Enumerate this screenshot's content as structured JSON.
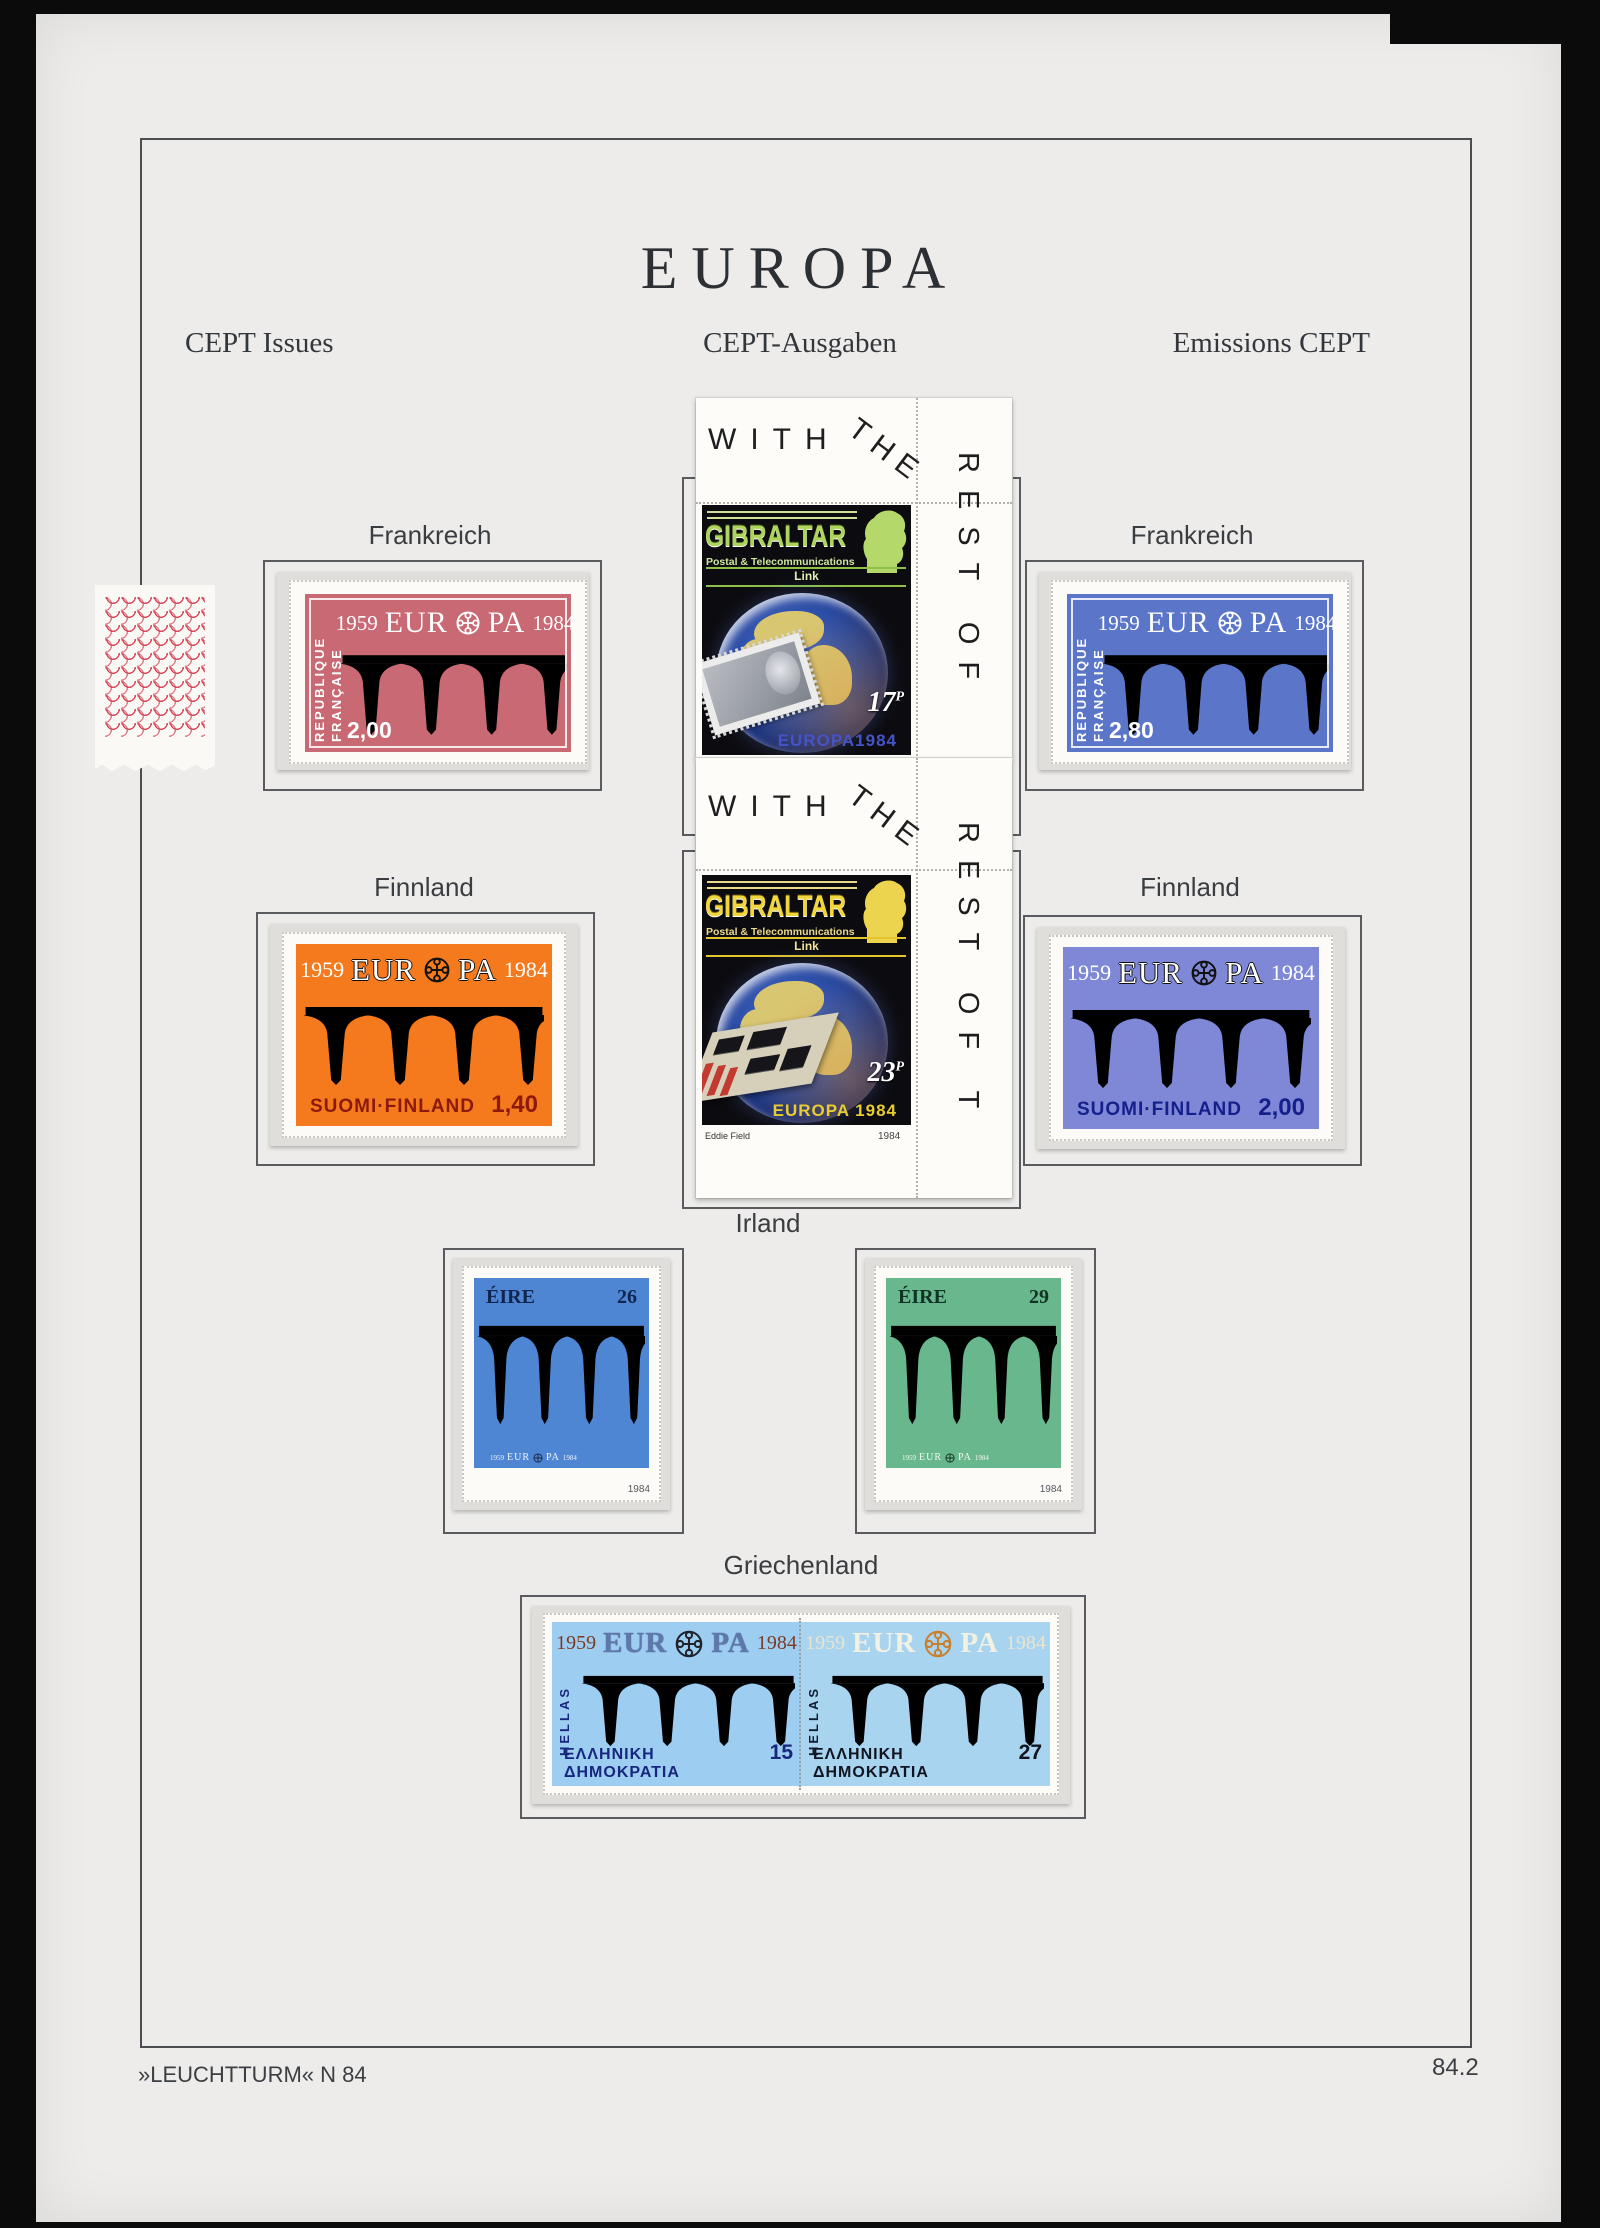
{
  "page": {
    "title": "EUROPA",
    "subtitle_left": "CEPT Issues",
    "subtitle_center": "CEPT-Ausgaben",
    "subtitle_right": "Emissions CEPT",
    "footer_left": "»LEUCHTTURM« N 84",
    "footer_right": "84.2"
  },
  "sections": {
    "france_left": "Frankreich",
    "france_right": "Frankreich",
    "finland_left": "Finnland",
    "finland_right": "Finnland",
    "ireland": "Irland",
    "greece": "Griechenland"
  },
  "common": {
    "year_left": "1959",
    "year_right": "1984",
    "eur": "EUR",
    "pa": "PA"
  },
  "france_red": {
    "country_line1": "REPUBLIQUE",
    "country_line2": "FRANÇAISE",
    "value": "2,00"
  },
  "france_blue": {
    "country_line1": "REPUBLIQUE",
    "country_line2": "FRANÇAISE",
    "value": "2,80"
  },
  "finland_orange": {
    "country": "SUOMI·FINLAND",
    "value": "1,40"
  },
  "finland_blue": {
    "country": "SUOMI·FINLAND",
    "value": "2,00"
  },
  "ireland_blue": {
    "country": "ÉIRE",
    "value": "26",
    "corner_year": "1984"
  },
  "ireland_green": {
    "country": "ÉIRE",
    "value": "29",
    "corner_year": "1984"
  },
  "greece_15": {
    "hellas": "HELLAS",
    "country": "ΕΛΛΗΝΙΚΗ ΔΗΜΟΚΡΑΤΙΑ",
    "value": "15"
  },
  "greece_27": {
    "hellas": "HELLAS",
    "country": "ΕΛΛΗΝΙΚΗ ΔΗΜΟΚΡΑΤΙΑ",
    "value": "27"
  },
  "gibraltar": {
    "name": "GIBRALTAR",
    "subtitle": "Postal & Telecommunications",
    "link": "Link",
    "margin_word1": "WITH",
    "margin_word2": "THE",
    "block1": {
      "margin_right": "REST OF",
      "value": "17",
      "unit": "P",
      "bottom_line": "EUROPA1984"
    },
    "block2": {
      "margin_right": "REST OF T",
      "value": "23",
      "unit": "P",
      "bottom_line": "EUROPA 1984",
      "designer": "Eddie Field",
      "plate_year": "1984"
    }
  },
  "colors": {
    "paper": "#edecea",
    "france_red_bg": "#c86974",
    "france_red_wave": "#a23b49",
    "france_blue_bg": "#5b76c8",
    "france_blue_wave": "#2742a6",
    "finland_orange_bg": "#f57a1e",
    "finland_orange_wave": "#d8490a",
    "finland_blue_bg": "#7e88d6",
    "finland_blue_wave": "#2a34a4",
    "ireland_blue_bg": "#4e86d4",
    "ireland_blue_wave": "#1d55b2",
    "ireland_green_bg": "#69b78c",
    "ireland_green_wave": "#1b6b4d",
    "greece_15_bg": "#9ecdf2",
    "greece_15_wave": "#2b53c6",
    "greece_27_bg": "#a8d4f0",
    "greece_27_wave": "#8279b5",
    "greece_27_bridge": "#a79b3f",
    "gibraltar_green": "#aed45e",
    "gibraltar_yellow": "#f0d63c"
  }
}
